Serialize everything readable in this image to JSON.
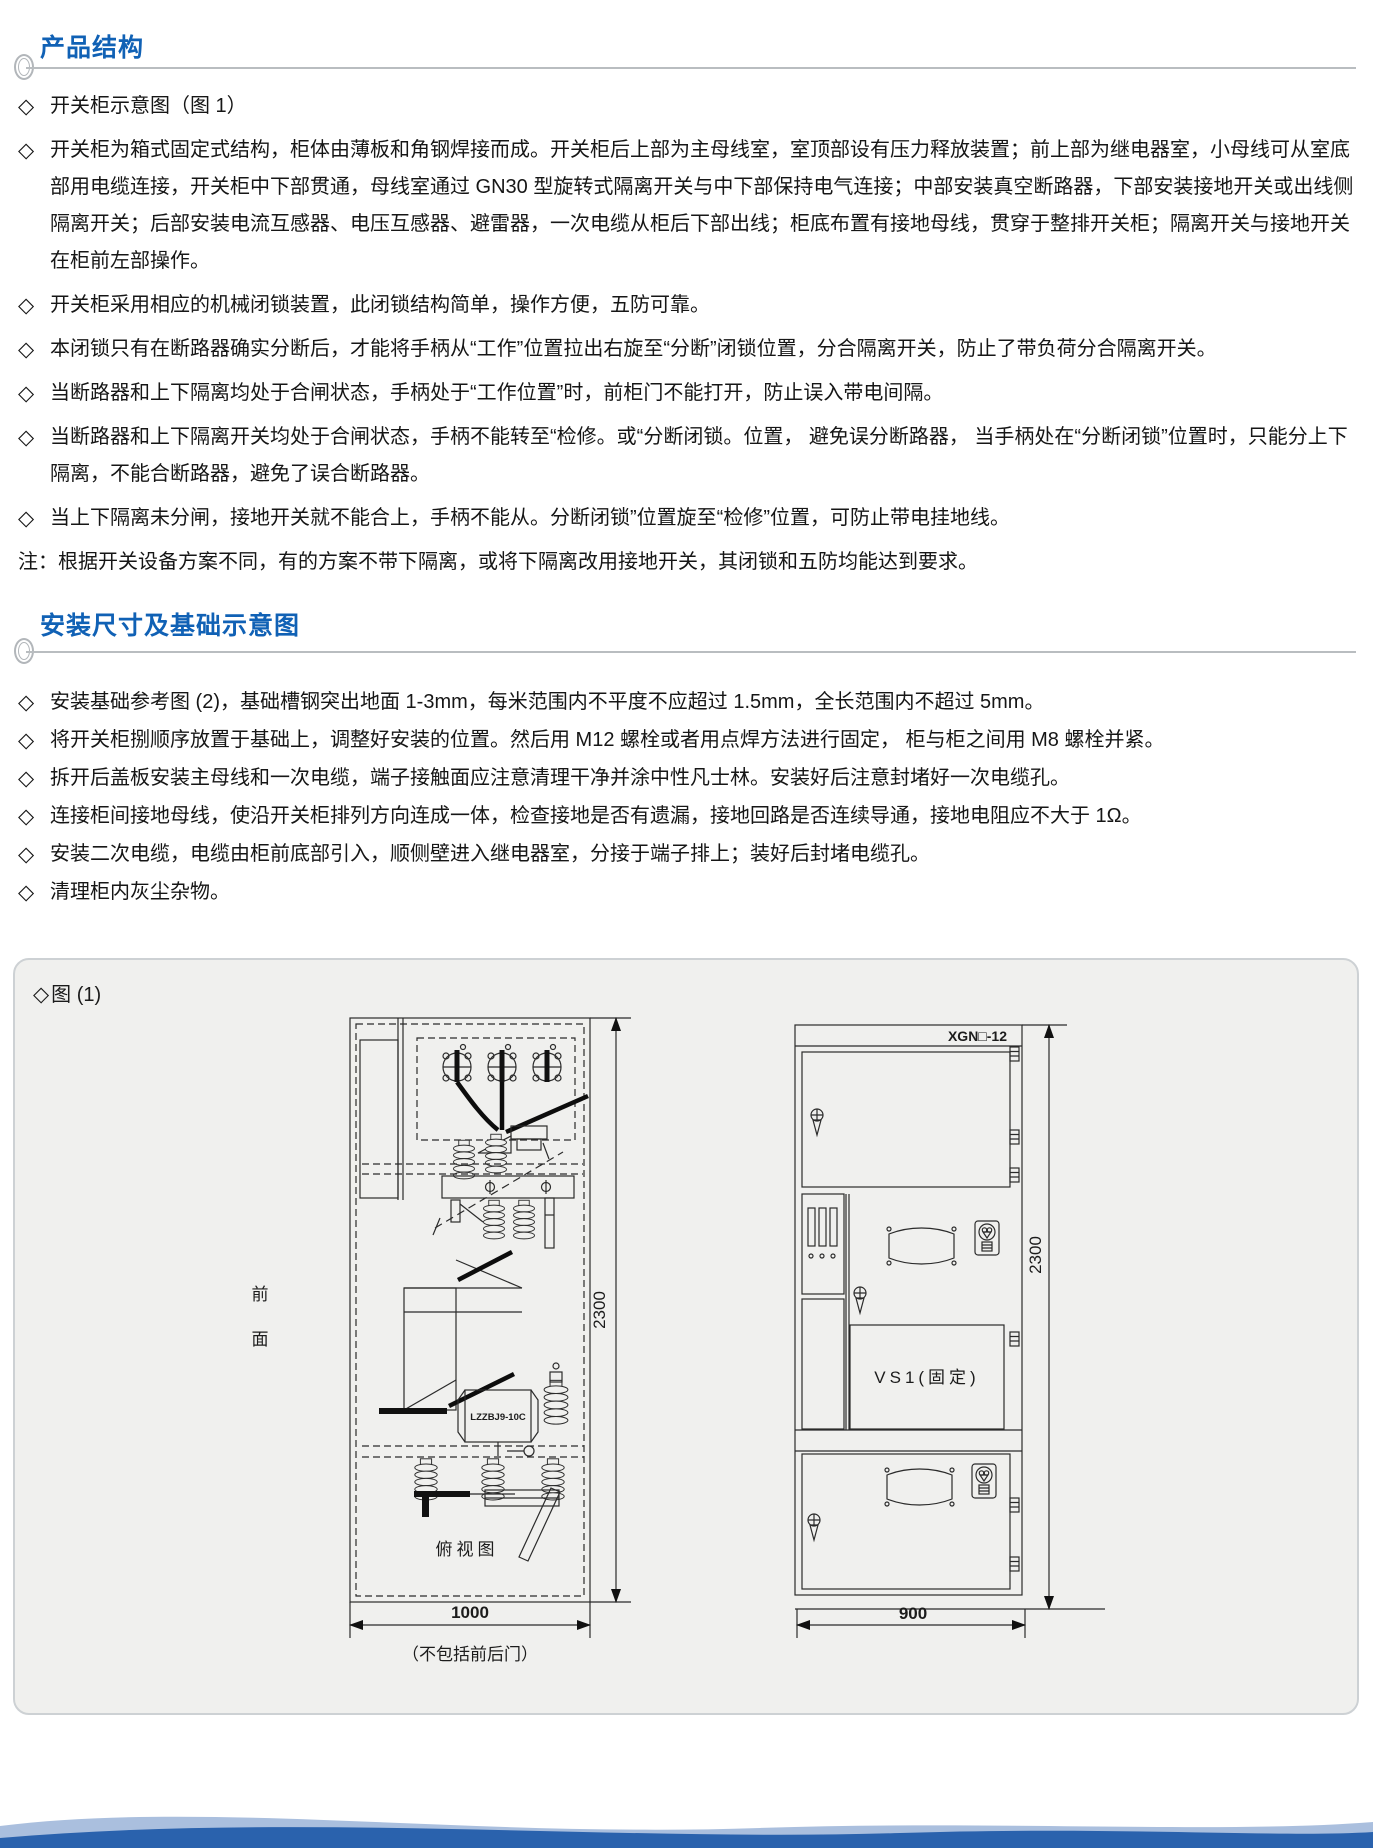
{
  "colors": {
    "accent_blue": "#1061b5",
    "figure_bg": "#f0f0ee",
    "footer_dark": "#2a62ad",
    "footer_light": "#9bb4d8"
  },
  "section_product": {
    "title": "产品结构",
    "items": [
      {
        "marker": "◇",
        "text": "开关柜示意图（图 1）"
      },
      {
        "marker": "◇",
        "text": "开关柜为箱式固定式结构，柜体由薄板和角钢焊接而成。开关柜后上部为主母线室，室顶部设有压力释放装置；前上部为继电器室，小母线可从室底部用电缆连接，开关柜中下部贯通，母线室通过 GN30 型旋转式隔离开关与中下部保持电气连接；中部安装真空断路器，下部安装接地开关或出线侧隔离开关；后部安装电流互感器、电压互感器、避雷器，一次电缆从柜后下部出线；柜底布置有接地母线，贯穿于整排开关柜；隔离开关与接地开关在柜前左部操作。"
      },
      {
        "marker": "◇",
        "text": "开关柜采用相应的机械闭锁装置，此闭锁结构简单，操作方便，五防可靠。"
      },
      {
        "marker": "◇",
        "text": "本闭锁只有在断路器确实分断后，才能将手柄从“工作”位置拉出右旋至“分断”闭锁位置，分合隔离开关，防止了带负荷分合隔离开关。"
      },
      {
        "marker": "◇",
        "text": "当断路器和上下隔离均处于合闸状态，手柄处于“工作位置”时，前柜门不能打开，防止误入带电间隔。"
      },
      {
        "marker": "◇",
        "text": "当断路器和上下隔离开关均处于合闸状态，手柄不能转至“检修。或“分断闭锁。位置， 避免误分断路器， 当手柄处在“分断闭锁”位置时，只能分上下隔离，不能合断路器，避免了误合断路器。"
      },
      {
        "marker": "◇",
        "text": "当上下隔离未分闸，接地开关就不能合上，手柄不能从。分断闭锁”位置旋至“检修”位置，可防止带电挂地线。"
      }
    ],
    "note": "注：根据开关设备方案不同，有的方案不带下隔离，或将下隔离改用接地开关，其闭锁和五防均能达到要求。"
  },
  "section_install": {
    "title": "安装尺寸及基础示意图",
    "items": [
      {
        "marker": "◇",
        "text": "安装基础参考图 (2)，基础槽钢突出地面 1-3mm，每米范围内不平度不应超过 1.5mm，全长范围内不超过 5mm。"
      },
      {
        "marker": "◇",
        "text": "将开关柜捌顺序放置于基础上，调整好安装的位置。然后用 M12 螺栓或者用点焊方法进行固定， 柜与柜之间用 M8 螺栓并紧。"
      },
      {
        "marker": "◇",
        "text": "拆开后盖板安装主母线和一次电缆，端子接触面应注意清理干净并涂中性凡士林。安装好后注意封堵好一次电缆孔。"
      },
      {
        "marker": "◇",
        "text": "连接柜间接地母线，使沿开关柜排列方向连成一体，检查接地是否有遗漏，接地回路是否连续导通，接地电阻应不大于 1Ω。"
      },
      {
        "marker": "◇",
        "text": "安装二次电缆，电缆由柜前底部引入，顺侧壁进入继电器室，分接于端子排上；装好后封堵电缆孔。"
      },
      {
        "marker": "◇",
        "text": "清理柜内灰尘杂物。"
      }
    ]
  },
  "figure": {
    "marker": "◇",
    "label": "图 (1)",
    "left": {
      "front_char_1": "前",
      "front_char_2": "面",
      "ct_label": "LZZBJ9-10C",
      "top_view_label": "俯视图",
      "height_dim": "2300",
      "width_dim": "1000",
      "width_note": "（不包括前后门）"
    },
    "right": {
      "model": "XGN□-12",
      "vcb_label": "VS1(固定)",
      "height_dim": "2300",
      "width_dim": "900"
    }
  }
}
